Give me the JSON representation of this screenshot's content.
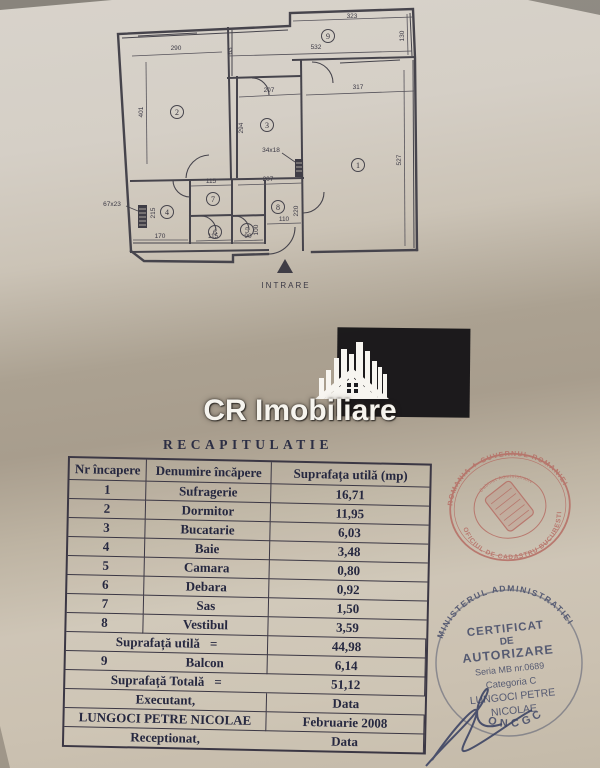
{
  "floor_plan": {
    "entrance_label": "INTRARE",
    "rooms": [
      "1",
      "2",
      "3",
      "4",
      "5",
      "6",
      "7",
      "8",
      "9"
    ],
    "dims": [
      {
        "id": "d323",
        "v": "323"
      },
      {
        "id": "d130",
        "v": "130"
      },
      {
        "id": "d532",
        "v": "532"
      },
      {
        "id": "d63",
        "v": "63"
      },
      {
        "id": "d290",
        "v": "290"
      },
      {
        "id": "d401",
        "v": "401"
      },
      {
        "id": "d207_room3",
        "v": "207"
      },
      {
        "id": "d294",
        "v": "294"
      },
      {
        "id": "d317",
        "v": "317"
      },
      {
        "id": "d527",
        "v": "527"
      },
      {
        "id": "d34x18",
        "v": "34x18"
      },
      {
        "id": "d67x23",
        "v": "67x23"
      },
      {
        "id": "d215",
        "v": "215"
      },
      {
        "id": "d170",
        "v": "170"
      },
      {
        "id": "d115_sas",
        "v": "115"
      },
      {
        "id": "d207_hall",
        "v": "207"
      },
      {
        "id": "d115_debara",
        "v": "115"
      },
      {
        "id": "d90",
        "v": "90"
      },
      {
        "id": "d100",
        "v": "100"
      },
      {
        "id": "d110",
        "v": "110"
      },
      {
        "id": "d220",
        "v": "220"
      }
    ]
  },
  "watermark": {
    "brand": "CR Imobiliare"
  },
  "recap": {
    "title": "RECAPITULATIE",
    "headers": [
      "Nr încapere",
      "Denumire încăpere",
      "Suprafața utilă  (mp)"
    ],
    "rows": [
      {
        "nr": "1",
        "name": "Sufragerie",
        "area": "16,71"
      },
      {
        "nr": "2",
        "name": "Dormitor",
        "area": "11,95"
      },
      {
        "nr": "3",
        "name": "Bucatarie",
        "area": "6,03"
      },
      {
        "nr": "4",
        "name": "Baie",
        "area": "3,48"
      },
      {
        "nr": "5",
        "name": "Camara",
        "area": "0,80"
      },
      {
        "nr": "6",
        "name": "Debara",
        "area": "0,92"
      },
      {
        "nr": "7",
        "name": "Sas",
        "area": "1,50"
      },
      {
        "nr": "8",
        "name": "Vestibul",
        "area": "3,59"
      }
    ],
    "subtotal_label": "Suprafață utilă",
    "subtotal_eq": "=",
    "subtotal_value": "44,98",
    "balcon": {
      "nr": "9",
      "name": "Balcon",
      "area": "6,14"
    },
    "total_label": "Suprafață  Totală",
    "total_eq": "=",
    "total_value": "51,12",
    "executant_label": "Executant,",
    "executant_data_label": "Data",
    "executant_name": "LUNGOCI PETRE NICOLAE",
    "date_value": "Februarie 2008",
    "receptionat_label": "Receptionat,",
    "receptionat_data_label": "Data"
  },
  "stamps": {
    "round": {
      "top_arc": "ROMANIA ✦ GUVERNUL ROMANIEI",
      "bottom_arc": "OFICIUL DE CADASTRU BUCURESTI",
      "inner_arc": "Cabinet Administrativ",
      "color": "#b66d64"
    },
    "certificate": {
      "arc_text": "MINISTERUL ADMINISTRATIEI",
      "line1": "CERTIFICAT",
      "line2": "DE",
      "line3": "AUTORIZARE",
      "line4": "Seria MB nr.0689",
      "line5": "Categoria C",
      "line6": "LUNGOCI PETRE",
      "line7": "NICOLAE",
      "bottom_arc": "ONCGC",
      "color": "#3d4565"
    }
  }
}
